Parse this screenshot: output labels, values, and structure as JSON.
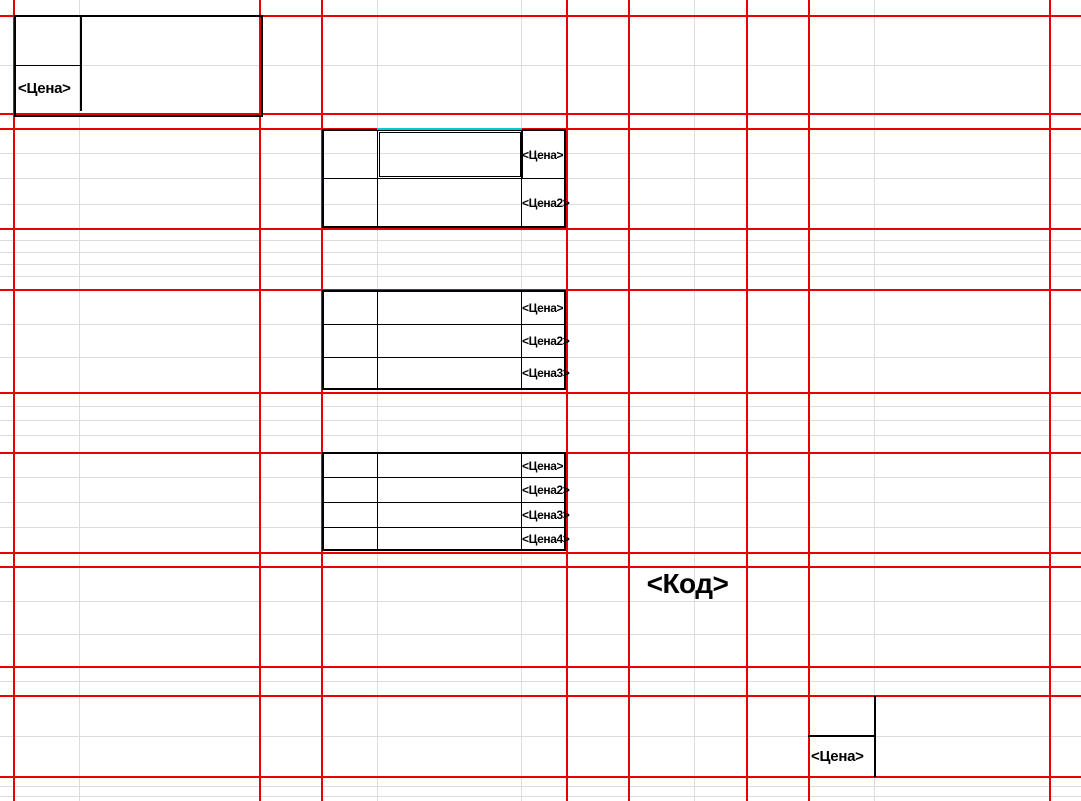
{
  "placeholders": {
    "top_left": {
      "price": "<Цена>"
    },
    "label_2row": {
      "rows": [
        "<Цена>",
        "<Цена2>"
      ]
    },
    "label_3row": {
      "rows": [
        "<Цена>",
        "<Цена2>",
        "<Цена3>"
      ]
    },
    "label_4row": {
      "rows": [
        "<Цена>",
        "<Цена2>",
        "<Цена3>",
        "<Цена4>"
      ]
    },
    "code": "<Код>",
    "bottom_right": {
      "price": "<Цена>"
    }
  },
  "colors": {
    "page_boundary_red": "#e80000",
    "cell_gridline_gray": "#dcdcdc",
    "template_border_black": "#000000",
    "selected_cell_accent": "#00cccc",
    "background": "#ffffff",
    "text": "#000000"
  }
}
